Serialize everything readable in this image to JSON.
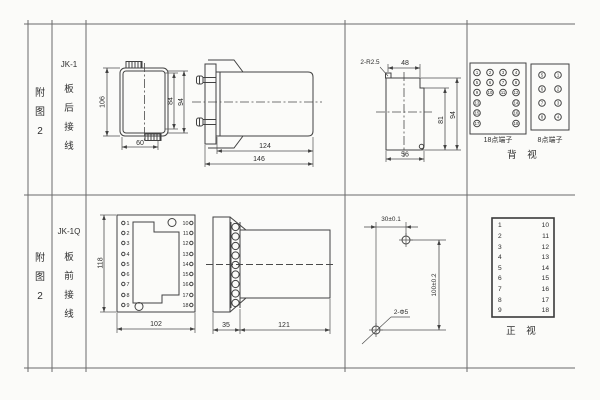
{
  "left_panel": {
    "row1": {
      "fig": "附\n图\n2",
      "model": "JK-1",
      "wiring": "板\n后\n接\n线"
    },
    "row2": {
      "fig": "附\n图\n2",
      "model": "JK-1Q",
      "wiring": "板\n前\n接\n线"
    }
  },
  "jk1": {
    "front_view": {
      "height_outer": "106",
      "height_inner": "84",
      "height_mid": "94",
      "width": "60"
    },
    "side_view": {
      "body_len": "124",
      "total_len": "146"
    },
    "panel_cutout": {
      "corner_radius": "2-R2.5",
      "top_width": "48",
      "height_inner": "81",
      "height_outer": "94",
      "bottom_width": "56"
    },
    "rear_view": {
      "label_18": "18点端子",
      "label_8": "8点端子",
      "caption": "背 视",
      "t18": [
        "1",
        "2",
        "3",
        "4",
        "5",
        "6",
        "7",
        "8",
        "9",
        "10",
        "11",
        "12",
        "13",
        "14",
        "15",
        "16",
        "17",
        "18"
      ],
      "t8_left": [
        "5",
        "6",
        "7",
        "8"
      ],
      "t8_right": [
        "1",
        "2",
        "3",
        "4"
      ]
    }
  },
  "jk1q": {
    "front_view": {
      "height": "118",
      "width": "102",
      "left": [
        "1",
        "2",
        "3",
        "4",
        "5",
        "6",
        "7",
        "8",
        "9"
      ],
      "right": [
        "10",
        "11",
        "12",
        "13",
        "14",
        "15",
        "16",
        "17",
        "18"
      ]
    },
    "side_view": {
      "plate_depth": "35",
      "body_len": "121"
    },
    "drill_view": {
      "h_dist": "30±0.1",
      "v_dist": "100±0.2",
      "holes": "2-Φ5"
    },
    "terminal_table": {
      "caption": "正 视",
      "left": [
        "1",
        "2",
        "3",
        "4",
        "5",
        "6",
        "7",
        "8",
        "9"
      ],
      "right": [
        "10",
        "11",
        "12",
        "13",
        "14",
        "15",
        "16",
        "17",
        "18"
      ]
    }
  }
}
